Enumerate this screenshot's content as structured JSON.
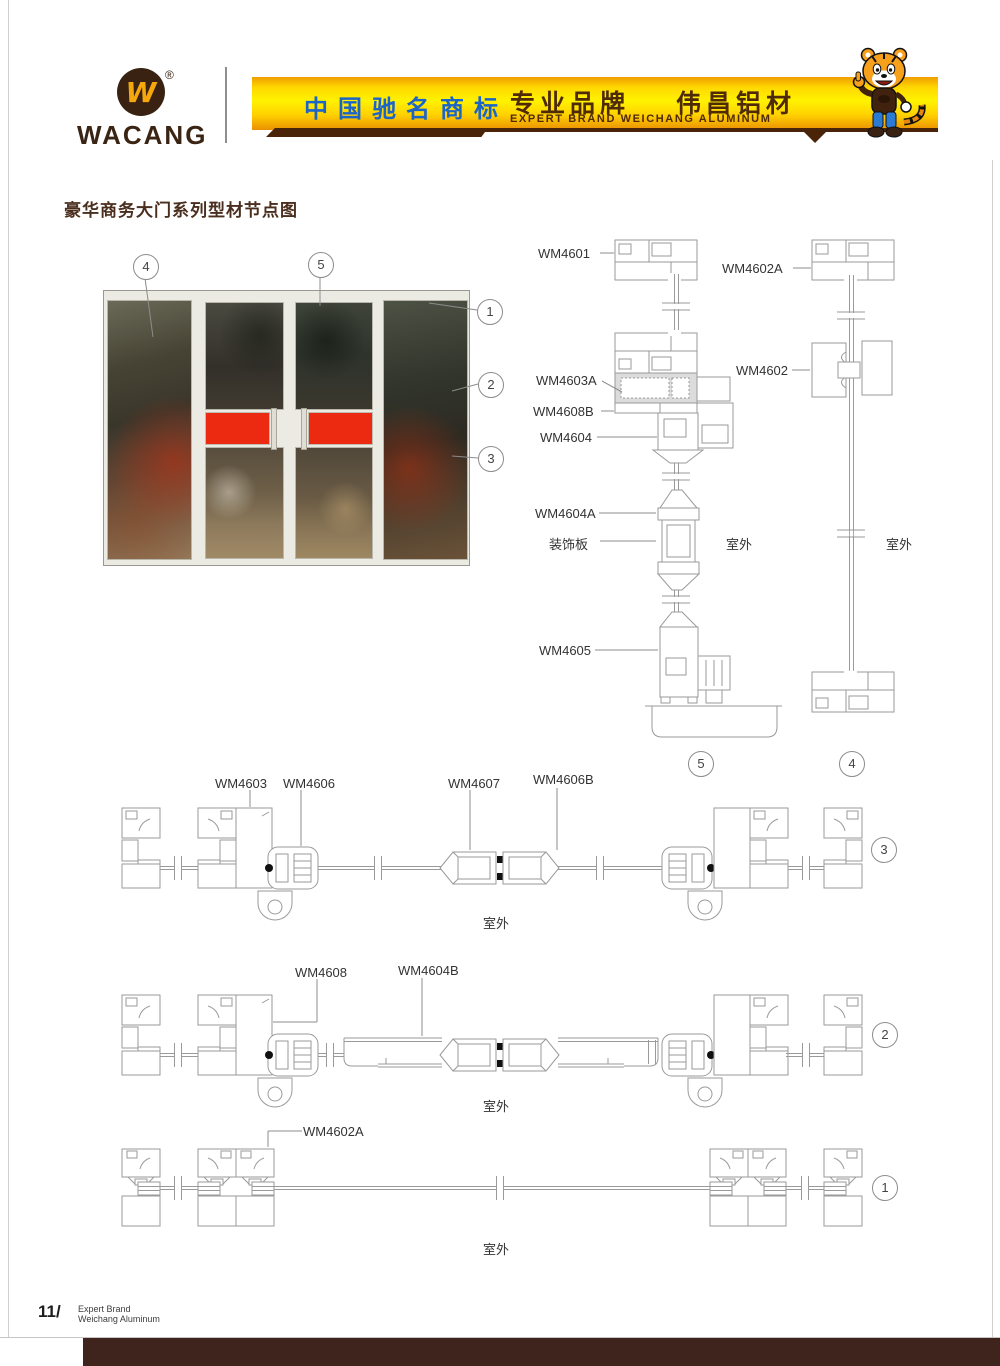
{
  "header": {
    "logo_text": "WACANG",
    "registered": "®",
    "banner": {
      "cn_badge": "中国驰名商标",
      "brand_left": "专业品牌",
      "brand_right": "伟昌铝材",
      "en_line": "EXPERT BRAND WEICHANG ALUMINUM"
    }
  },
  "page": {
    "title": "豪华商务大门系列型材节点图"
  },
  "labels": {
    "wm4601": "WM4601",
    "wm4602": "WM4602",
    "wm4602a": "WM4602A",
    "wm4603": "WM4603",
    "wm4603a": "WM4603A",
    "wm4604": "WM4604",
    "wm4604a": "WM4604A",
    "wm4604b": "WM4604B",
    "wm4605": "WM4605",
    "wm4606": "WM4606",
    "wm4606b": "WM4606B",
    "wm4607": "WM4607",
    "wm4608": "WM4608",
    "wm4608b": "WM4608B",
    "decorative_panel": "装饰板",
    "outdoor": "室外"
  },
  "callouts": {
    "n1": "1",
    "n2": "2",
    "n3": "3",
    "n4": "4",
    "n5": "5"
  },
  "footer": {
    "page_no": "11/",
    "line1": "Expert Brand",
    "line2": "Weichang Aluminum"
  },
  "colors": {
    "banner_yellow": "#ffd800",
    "banner_orange": "#ef9d00",
    "badge_blue": "#1b64c8",
    "brand_brown": "#4e2a06",
    "bar_brown": "#3f241d",
    "red_panel": "#ec2a12",
    "cad_gray": "#9a9a9a"
  }
}
